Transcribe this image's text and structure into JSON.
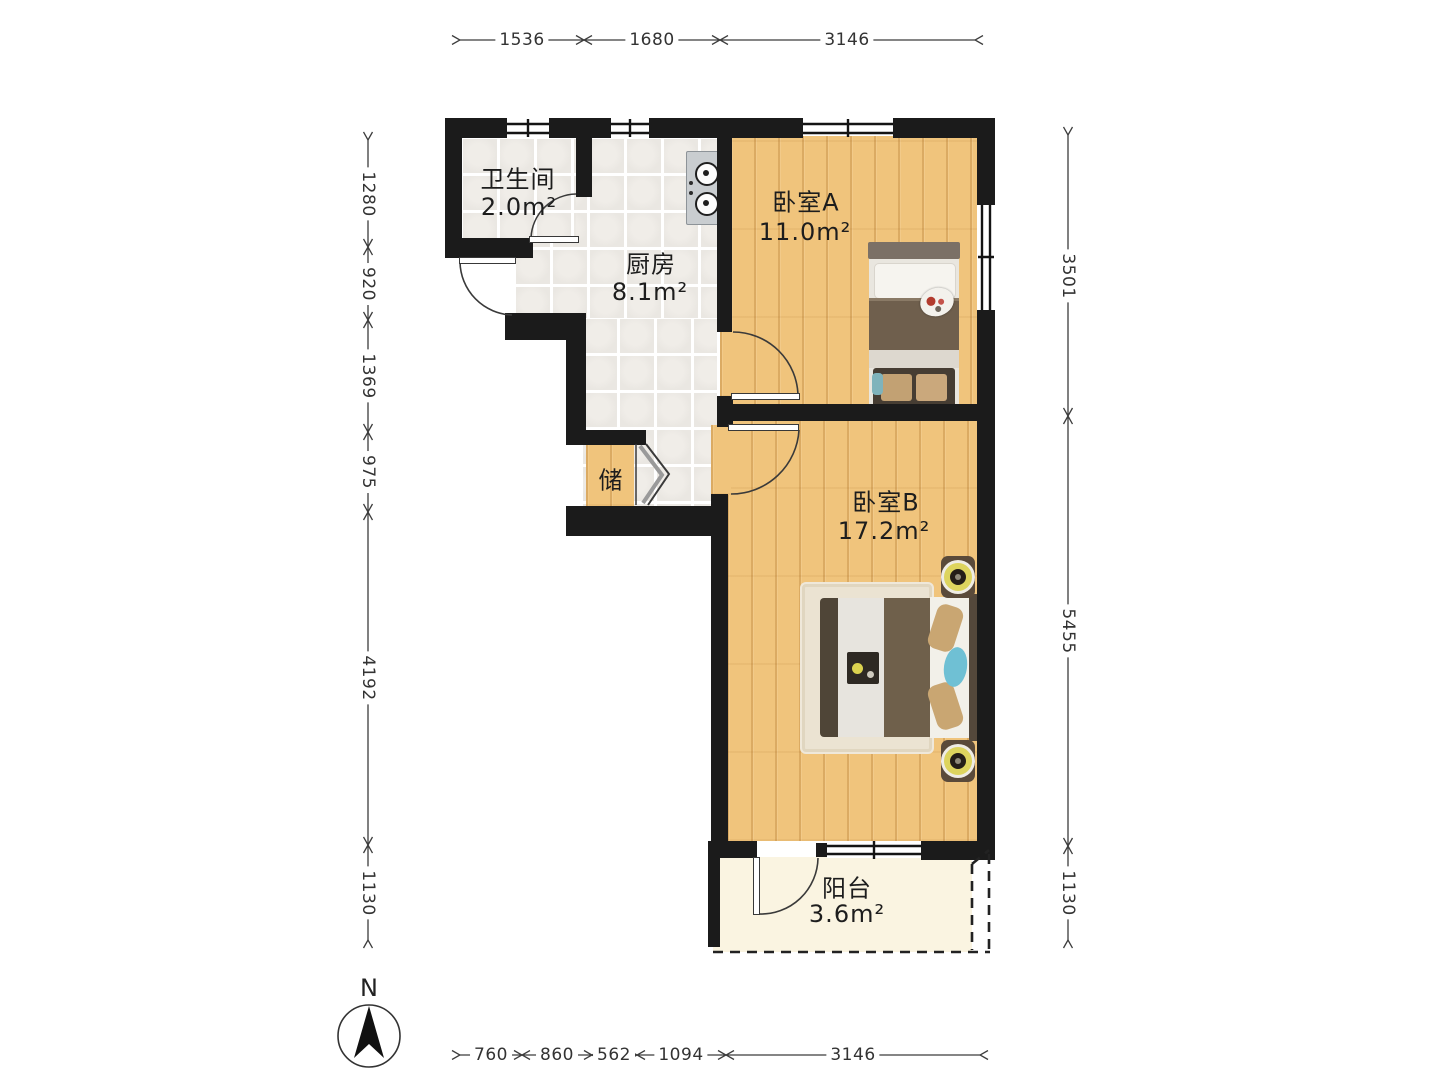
{
  "compass": {
    "label": "N"
  },
  "rooms": {
    "bathroom": {
      "name": "卫生间",
      "area": "2.0m²"
    },
    "kitchen": {
      "name": "厨房",
      "area": "8.1m²"
    },
    "bedroom_a": {
      "name": "卧室A",
      "area": "11.0m²"
    },
    "bedroom_b": {
      "name": "卧室B",
      "area": "17.2m²"
    },
    "storage": {
      "name": "储"
    },
    "balcony": {
      "name": "阳台",
      "area": "3.6m²"
    }
  },
  "dimensions_mm": {
    "top": [
      "1536",
      "1680",
      "3146"
    ],
    "bottom": [
      "760",
      "860",
      "562",
      "1094",
      "3146"
    ],
    "left": [
      "1280",
      "920",
      "1369",
      "975",
      "4192",
      "1130"
    ],
    "right": [
      "3501",
      "5455",
      "1130"
    ]
  },
  "colors": {
    "wall": "#1b1b1b",
    "wood_floor": "#f0c47c",
    "tile_floor": "#eae7e2",
    "balcony_floor": "#faf4e1",
    "accent_yellow": "#ddd45e",
    "accent_teal": "#6fc0d4"
  }
}
